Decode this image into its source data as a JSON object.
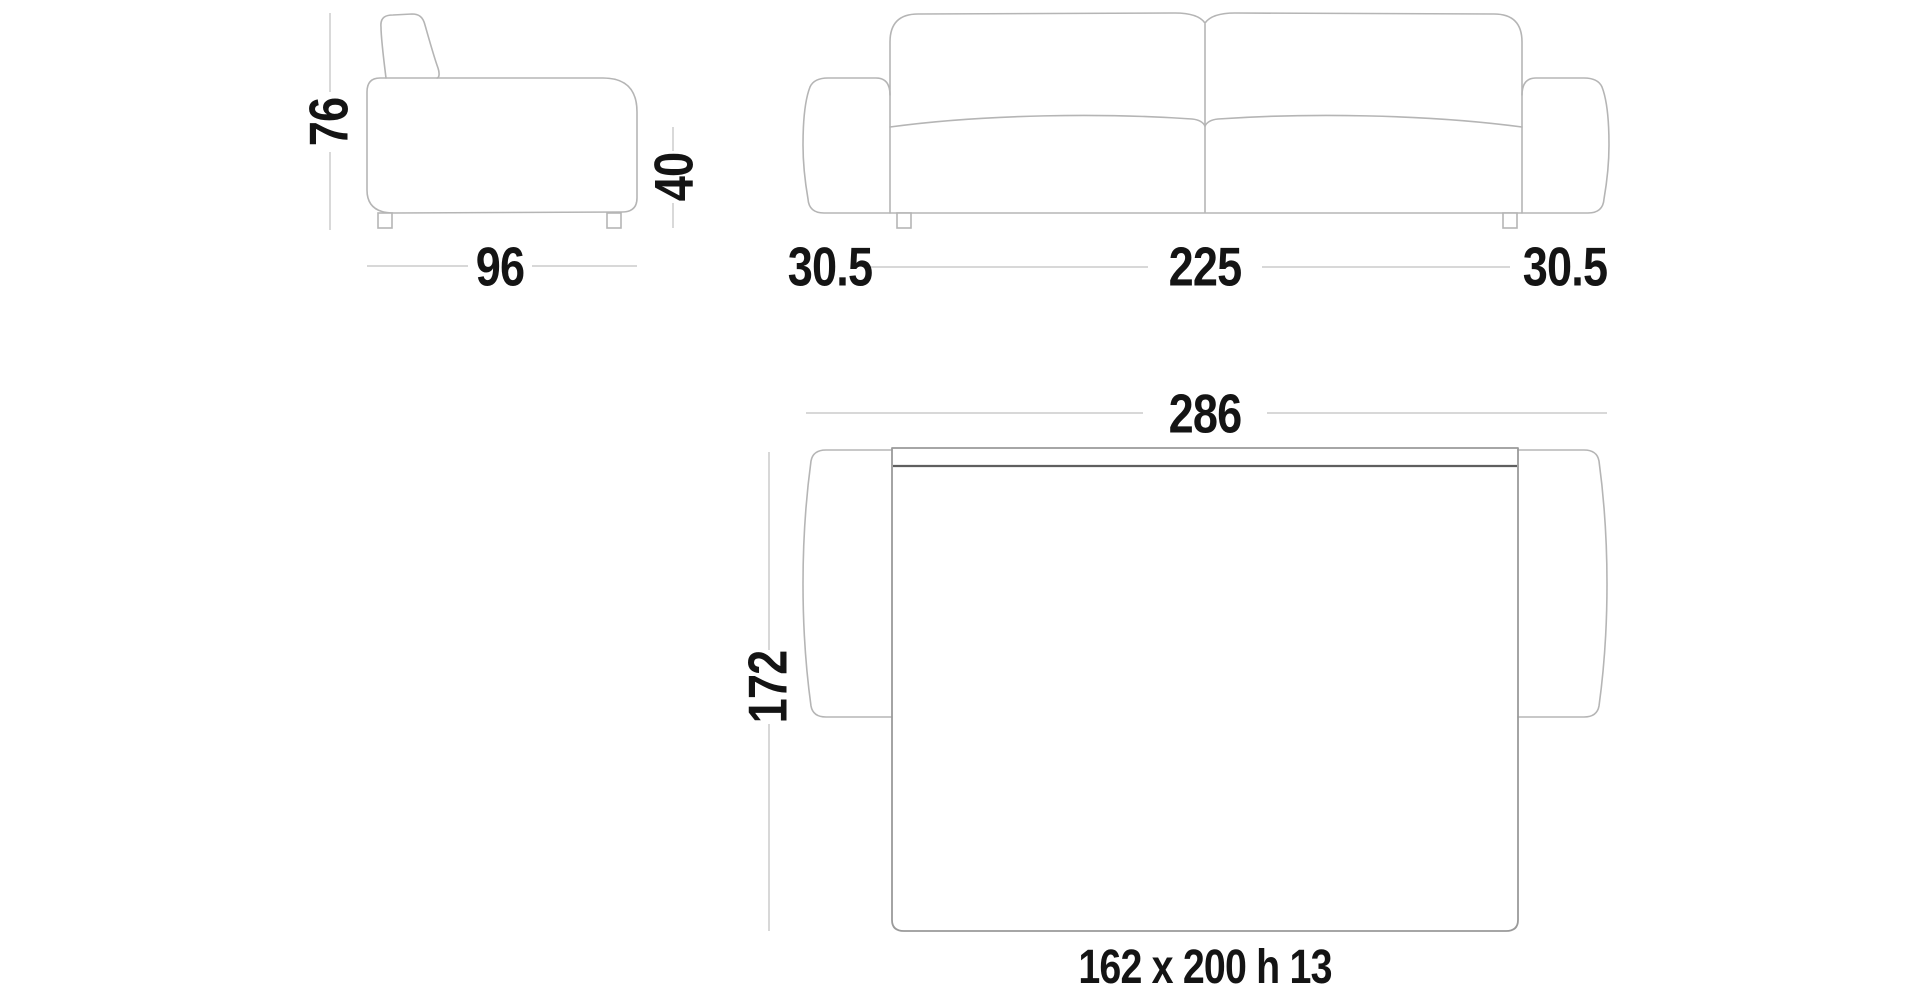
{
  "colors": {
    "outline": "#b5b5b5",
    "dim_line": "#cccccc",
    "bed_outline": "#9a9a9a",
    "fold_line": "#5f5f5f",
    "text": "#141414",
    "background": "#ffffff"
  },
  "side_view": {
    "height": "76",
    "seat_height": "40",
    "depth": "96"
  },
  "front_view": {
    "arm_left_width": "30.5",
    "seat_width": "225",
    "arm_right_width": "30.5"
  },
  "plan_view": {
    "total_width": "286",
    "total_depth": "172",
    "mattress_size": "162 x 200 h 13"
  }
}
